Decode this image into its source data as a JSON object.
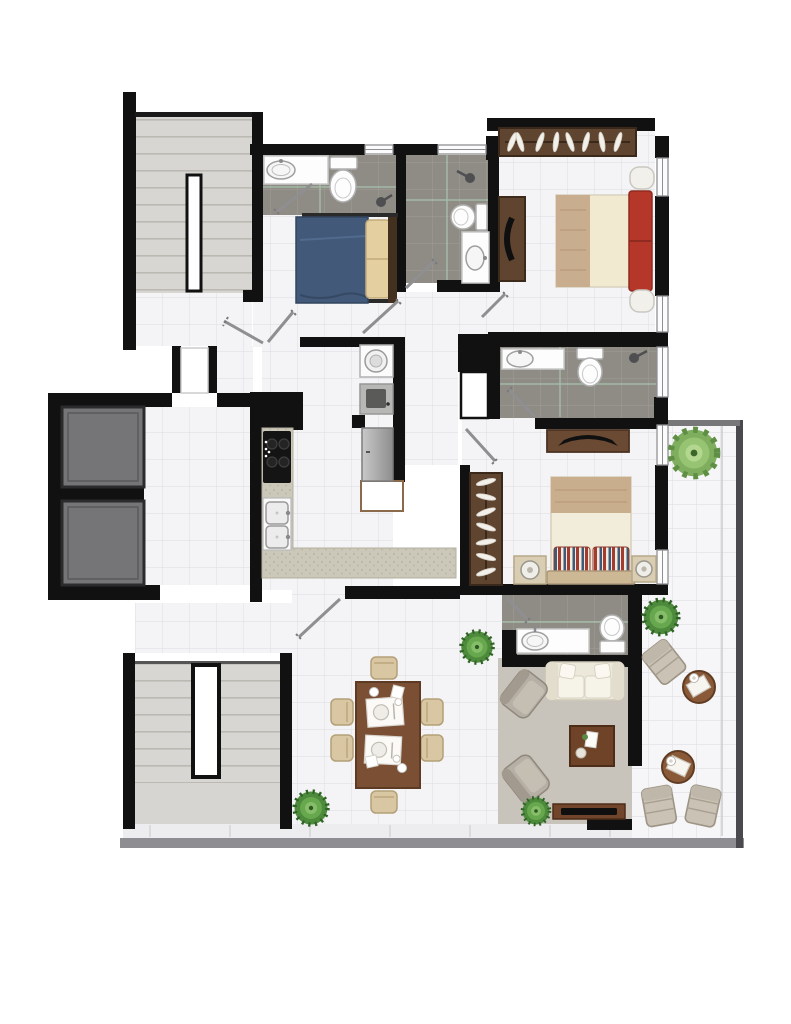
{
  "meta": {
    "title": "Apartment floor plan — top view",
    "type": "architectural-floor-plan",
    "visible_text": "none"
  },
  "palette": {
    "wall": "#111111",
    "floor_tile": "#f4f4f6",
    "tile_grid": "#e2e2e6",
    "bath_tile": "#8f8c85",
    "bath_grout": "#9d9a93",
    "bath_accent_grout": "#aed3b8",
    "stair_floor": "#d8d6d2",
    "stair_tread": "#bcb9b3",
    "elevator_car": "#757577",
    "wood_dark": "#5f4430",
    "wood_mid": "#7b4f34",
    "bed_blue": "#42597a",
    "bedding_cream": "#f2edda",
    "headboard_red": "#b5372a",
    "blanket_tan": "#c9ae8d",
    "pillow_beige": "#e3cfa0",
    "sofa_cream": "#eeeadb",
    "rug_gray": "#c8c4bc",
    "dining_chair_beige": "#d9c6a2",
    "lounge_gray": "#c9c2b5",
    "armchair_gray": "#b5afa5",
    "plant_green": "#4e8a3c",
    "plant_light_green": "#8fbe6f",
    "appliance_gray": "#b9b9b9",
    "counter_speckle": "#cbc8b9",
    "railing_dark": "#4a4a4e",
    "window_frame": "#8f8f93"
  },
  "rooms": {
    "stairwell_upper": {
      "label": "stairwell (top-left)",
      "features": [
        "staircase treads",
        "central stair void"
      ]
    },
    "elevator_shaft": {
      "label": "elevator shaft",
      "cars": 2
    },
    "entry_hall": {
      "label": "entry hall / corridor",
      "features": [
        "recessed entry niche",
        "hallway beside elevators"
      ]
    },
    "bathroom_1": {
      "label": "bathroom (top)",
      "fixtures": [
        "vanity sink",
        "toilet",
        "shower head"
      ]
    },
    "bedroom_1": {
      "label": "small bedroom",
      "furniture": [
        "single bed with blue duvet",
        "two beige pillows",
        "dark wood headboard"
      ]
    },
    "bathroom_2": {
      "label": "ensuite bathroom",
      "fixtures": [
        "shower head",
        "toilet",
        "vanity sink"
      ]
    },
    "master_bedroom": {
      "label": "master bedroom",
      "furniture": [
        "wardrobe with hangers",
        "double bed with cream duvet and tan throw",
        "red upholstered headboard",
        "two nightstands",
        "dresser with curved TV"
      ]
    },
    "laundry_nook": {
      "label": "laundry / service column",
      "appliances": [
        "washing machine",
        "laundry tub",
        "refrigerator",
        "white cabinet"
      ]
    },
    "kitchen": {
      "label": "kitchen",
      "features": [
        "black cooktop",
        "double sink",
        "L-shaped speckled counter"
      ]
    },
    "bathroom_3": {
      "label": "bathroom (middle)",
      "fixtures": [
        "vanity sink",
        "toilet",
        "shower head",
        "service shaft"
      ]
    },
    "bedroom_2": {
      "label": "second bedroom",
      "furniture": [
        "wardrobe with hangers",
        "double bed with striped pillows",
        "two nightstands with round lamps",
        "dresser with TV"
      ]
    },
    "powder_room": {
      "label": "powder room",
      "fixtures": [
        "vanity sink",
        "toilet"
      ]
    },
    "dining_area": {
      "label": "dining area",
      "furniture": [
        "six-seat wooden table",
        "six beige chairs",
        "two place settings"
      ]
    },
    "living_room": {
      "label": "living room",
      "furniture": [
        "cream three-seat sofa",
        "two gray armchairs",
        "wooden coffee table",
        "TV console",
        "wall-to-wall gray rug"
      ]
    },
    "balcony": {
      "label": "balcony / terrace",
      "furniture": [
        "three sun loungers",
        "two round side tables with trays",
        "perimeter railing"
      ]
    },
    "stairwell_lower": {
      "label": "stairwell (bottom-left)",
      "features": [
        "staircase treads",
        "central stair void"
      ]
    }
  },
  "counts": {
    "door_swings": 10,
    "windows": 7,
    "potted_plants": 5,
    "elevator_cars": 2,
    "stairwells": 2
  }
}
